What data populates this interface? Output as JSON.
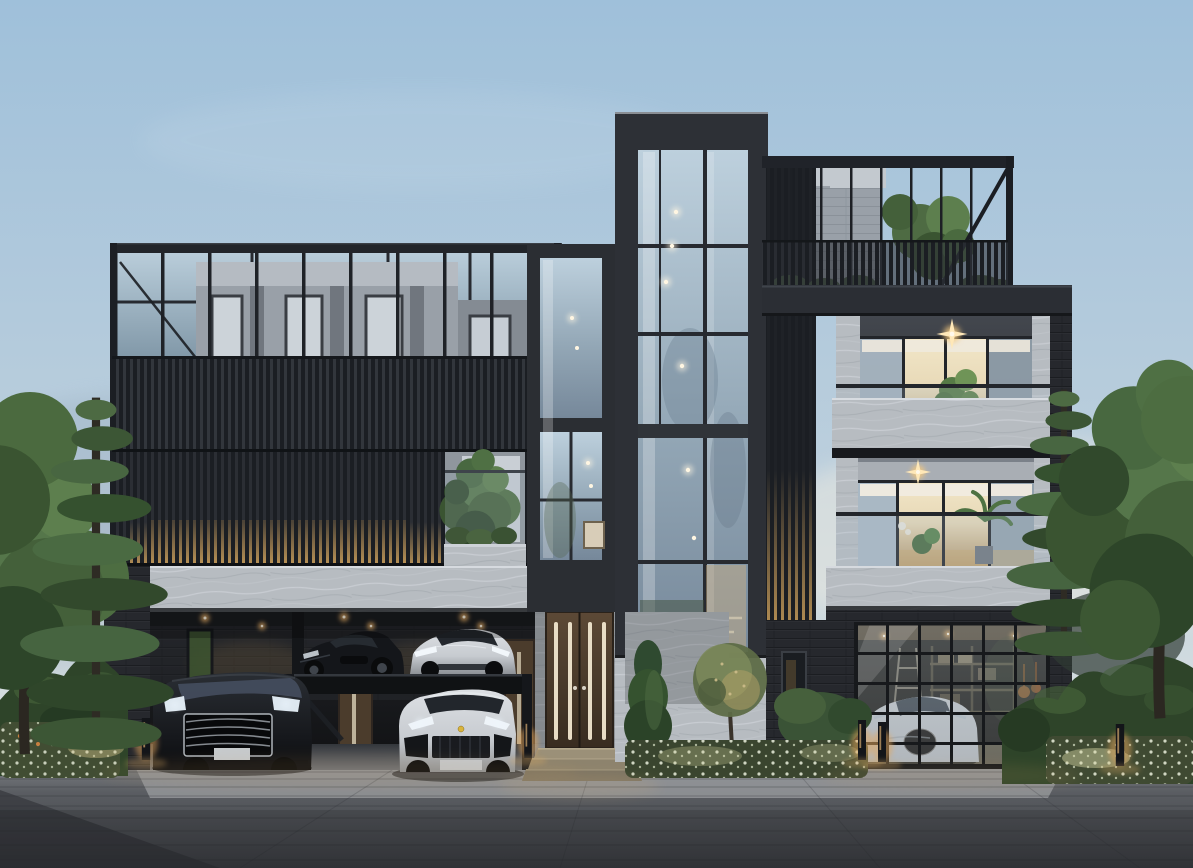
{
  "scene": {
    "description": "Dusk architectural rendering of a modern three-storey luxury residence with charcoal metal facades, vertical slat screens, floor-to-ceiling glazing, marble stone bands, rooftop terraces, a two-level car lift carport and a glass-door garage",
    "time_of_day": "dusk",
    "building": {
      "left_block": [
        "rooftop pergola frame",
        "grey penthouse volume",
        "vertical slat screen facade",
        "marble stone band",
        "double-height carport with car lift"
      ],
      "center": [
        "tall glass stair tower with interior downlights",
        "two-storey glass entry column",
        "timber entry door with lit glass strips",
        "entry steps"
      ],
      "right_block": [
        "roof terrace with railing and tree",
        "third-floor balcony with plants",
        "second-floor lounge with warm light",
        "glass sectional garage door"
      ]
    },
    "vehicles": [
      {
        "name": "black supercar on upper lift deck"
      },
      {
        "name": "silver sedan on upper lift deck"
      },
      {
        "name": "black luxury van in carport"
      },
      {
        "name": "silver sport SUV in carport"
      },
      {
        "name": "white hypercar inside garage"
      }
    ],
    "landscape": [
      "left deciduous tree",
      "left pine tree",
      "left hedge with flowers",
      "entry garden with round shrub tree and white flowers",
      "right pine tree",
      "right deciduous tree",
      "right sculpted hedge",
      "paver driveway"
    ],
    "lighting": [
      "warm recessed carport downlights",
      "glowing slat screen base",
      "balcony star flares",
      "bollard path lights",
      "interior warm room light"
    ]
  },
  "palette": {
    "sky_top": "#9fc0da",
    "sky_mid": "#bccfdd",
    "sky_horizon": "#e6e7e1",
    "charcoal_dark": "#2d3036",
    "charcoal_mid": "#2b2e34",
    "slat_dark": "#1b1e23",
    "stone_light": "#b7bcc1",
    "glass_cool_top": "#b9cdda",
    "glass_cool_bottom": "#8299a9",
    "glass_warm": "#e7d8b6",
    "wood_door": "#5c4936",
    "light_warm": "#f3b86d",
    "flower_white": "#e9eedb",
    "hedge_green": "#2e4429",
    "tree_green": "#4a6a3f",
    "car_black": "#0c0d10",
    "car_silver": "#c7cbd0",
    "car_white": "#d6d9dc",
    "paver_light": "#8b8e92",
    "paver_mid": "#5a5d62",
    "paver_dark": "#393b40"
  }
}
